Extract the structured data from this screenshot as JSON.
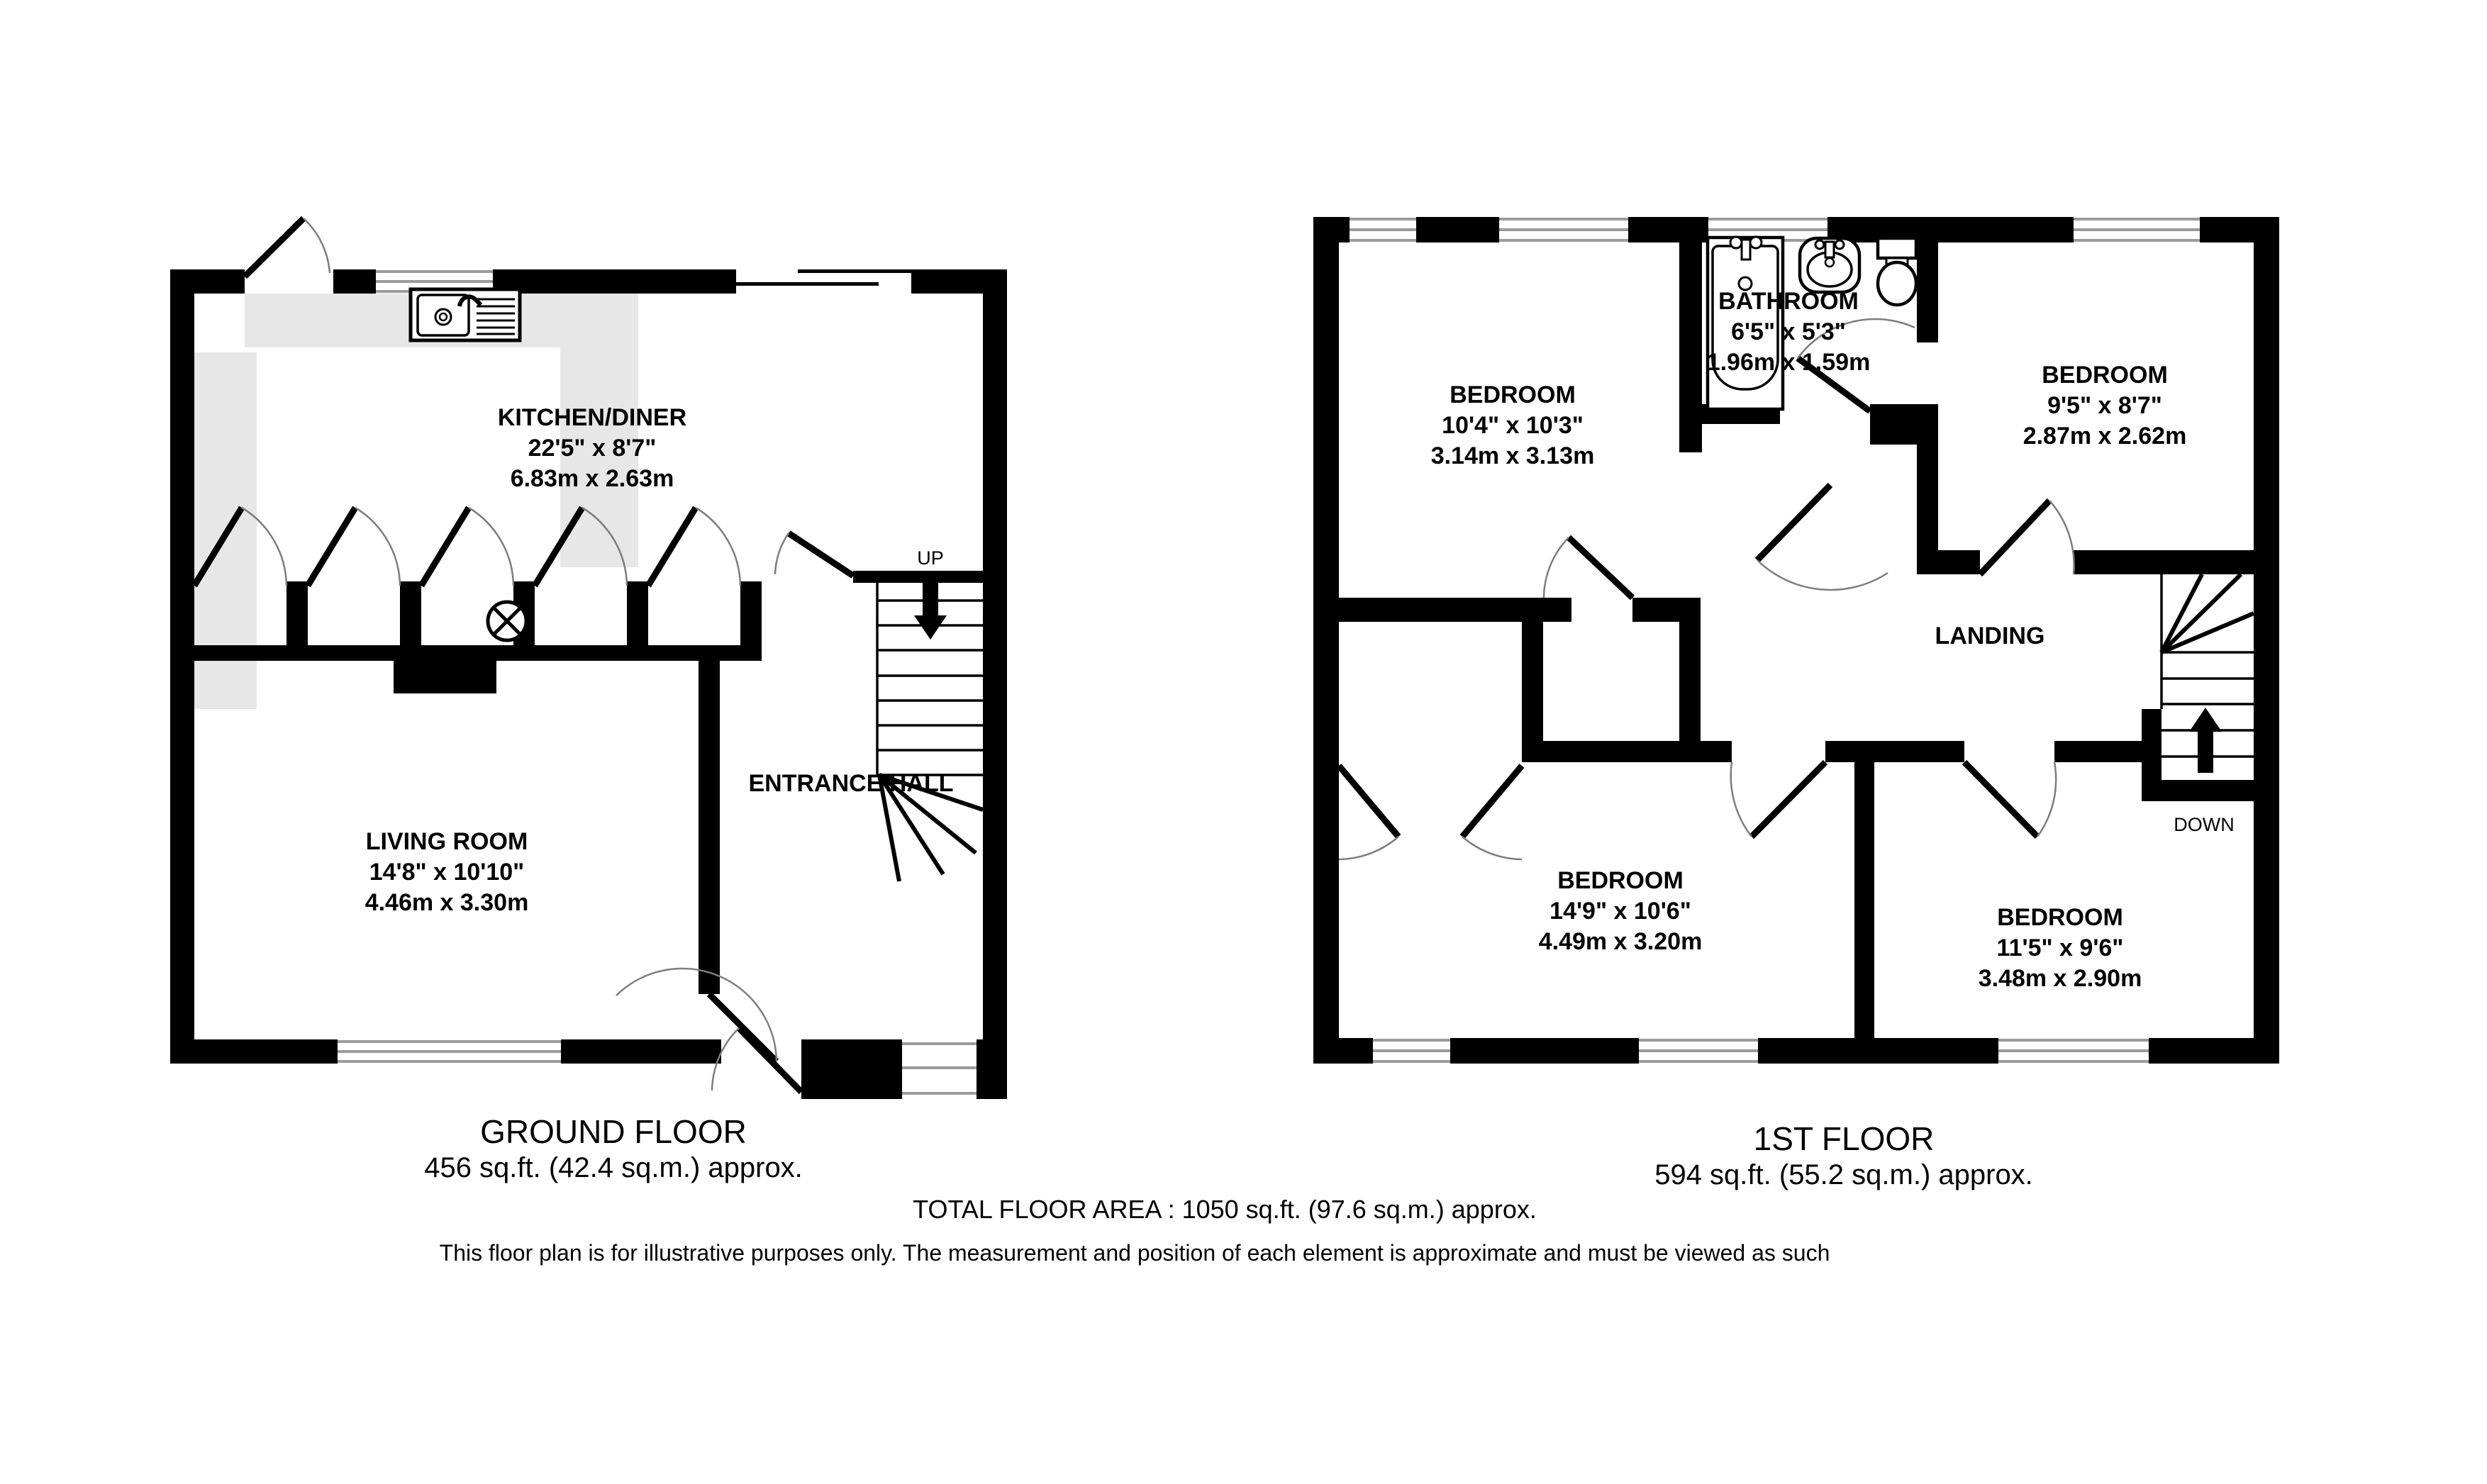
{
  "colors": {
    "wall": "#000000",
    "counter": "#e7e7e7",
    "window_line": "#9b9b9b",
    "door_arc": "#7d7d7d",
    "background": "#ffffff"
  },
  "gf": {
    "title": "GROUND FLOOR",
    "area": "456 sq.ft. (42.4 sq.m.) approx.",
    "kitchen": {
      "name": "KITCHEN/DINER",
      "imperial": "22'5\"  x 8'7\"",
      "metric": "6.83m  x 2.63m"
    },
    "living": {
      "name": "LIVING ROOM",
      "imperial": "14'8\"  x 10'10\"",
      "metric": "4.46m  x 3.30m"
    },
    "hall": {
      "name": "ENTRANCE HALL"
    },
    "stairs": "UP"
  },
  "ff": {
    "title": "1ST FLOOR",
    "area": "594 sq.ft. (55.2 sq.m.) approx.",
    "bed1": {
      "name": "BEDROOM",
      "imperial": "10'4\"  x 10'3\"",
      "metric": "3.14m  x 3.13m"
    },
    "bath": {
      "name": "BATHROOM",
      "imperial": "6'5\"  x 5'3\"",
      "metric": "1.96m  x 1.59m"
    },
    "bed2": {
      "name": "BEDROOM",
      "imperial": "9'5\"  x 8'7\"",
      "metric": "2.87m  x 2.62m"
    },
    "bed3": {
      "name": "BEDROOM",
      "imperial": "14'9\"  x 10'6\"",
      "metric": "4.49m  x 3.20m"
    },
    "bed4": {
      "name": "BEDROOM",
      "imperial": "11'5\"  x 9'6\"",
      "metric": "3.48m  x 2.90m"
    },
    "landing": "LANDING",
    "stairs": "DOWN"
  },
  "footer": {
    "total": "TOTAL FLOOR AREA : 1050 sq.ft. (97.6 sq.m.) approx.",
    "disclaimer": "This floor plan is for illustrative purposes only. The measurement and position of each element is approximate and must be viewed as such"
  }
}
